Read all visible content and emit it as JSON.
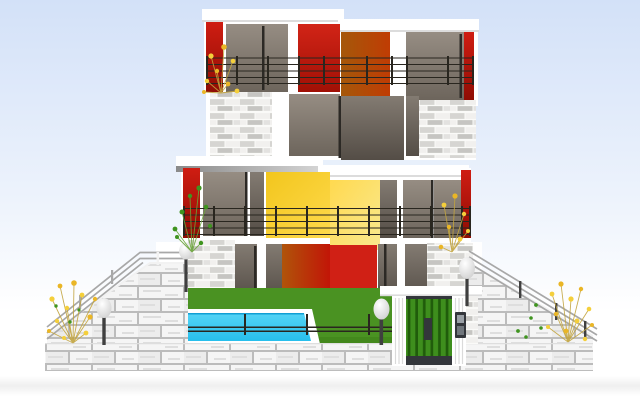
{
  "scene": {
    "title": "Modern three-story house with balconies, swimming pool, lawn, entrance gate and stone stairways — flat vector illustration",
    "elements": [
      "sky",
      "third-floor",
      "middle-band",
      "second-floor",
      "ground-floor",
      "balcony-railings",
      "stone-piers",
      "lawn",
      "swimming-pool",
      "garden-fence",
      "entrance-gate",
      "intercom",
      "lamp-posts",
      "stair-ramp-left",
      "stair-ramp-right",
      "retaining-wall",
      "flowers"
    ]
  },
  "colors": {
    "sky_top": "#d3e1f8",
    "sky_mid": "#edf3fc",
    "white": "#ffffff",
    "slab_shadow": "#dcdcdc",
    "under_dark": "#8a8a8a",
    "under_light": "#d6d6d6",
    "redstrip_top": "#cf1d12",
    "redstrip_bottom": "#8f0d04",
    "red_top": "#d22417",
    "red_bottom": "#a01005",
    "red_bright": "#d02015",
    "orange_left": "#a5580a",
    "orange_right": "#c03c04",
    "orangered_left": "#b0540a",
    "orangered_right": "#c21507",
    "yellowa_top": "#f2c61d",
    "yellowa_bottom": "#fed94b",
    "yellowb_top": "#ffd94f",
    "yellowb_bottom": "#f9e98f",
    "taupe_top": "#968d83",
    "taupe_bottom": "#6d655c",
    "tauped_top": "#837b72",
    "tauped_bottom": "#544d46",
    "mullion": "#2c2925",
    "stone_base": "#e3e2e0",
    "stone_light": "#f1f0ee",
    "stone_mid": "#d6d5d2",
    "stone_dark": "#c6c5c2",
    "mortar": "#fafaf8",
    "block_base": "#ececec",
    "block_light": "#f5f5f5",
    "block_joint": "#bcbcbc",
    "block_shade": "#dedede",
    "lawn": "#4a9222",
    "lawn_shadow": "#3b7d17",
    "water_top": "#55d4f6",
    "water_bottom": "#27bfec",
    "water_edge": "#129fd4",
    "gate_green": "#3e8e1d",
    "gate_stripe": "#205c0b",
    "gate_dark": "#33363b",
    "gate_back": "#4f4a43",
    "intercom_light": "#9aa0a6",
    "intercom_mid": "#70767c",
    "rail_dark": "#29261f",
    "rail_gray": "#a8a8a8",
    "ramp_edge": "#f2f2f2",
    "globe_hi": "#ffffff",
    "globe_lo": "#c9c9c9",
    "post": "#3f3f3f",
    "flower_yellow": "#f4cf3b",
    "flower_gold": "#eab626",
    "stem": "#c2a43f",
    "plant_green": "#3f941f",
    "stem_green": "#6aa43a",
    "ground_band": "#efefef",
    "ridge": "#dadada"
  }
}
